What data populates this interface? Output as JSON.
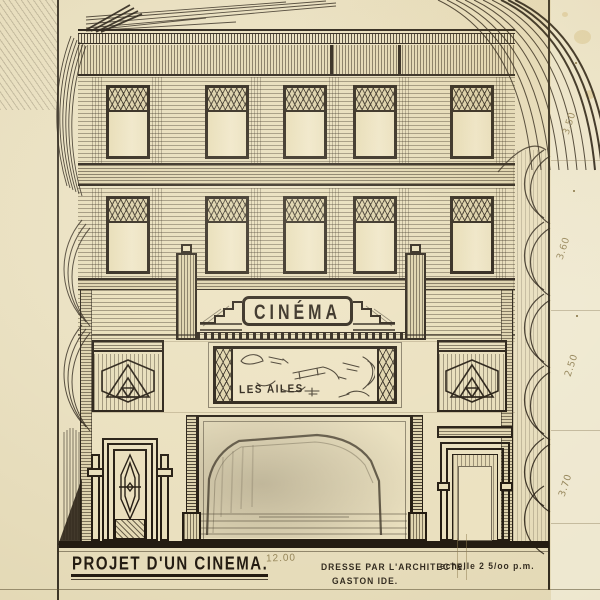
{
  "titles": {
    "project_title": "PROJET D'UN CINEMA.",
    "architect_line": "DRESSE PAR L'ARCHITECTE.",
    "architect_name": "GASTON IDE.",
    "scale_note": "echelle 2 5/oo p.m."
  },
  "facade": {
    "marquee_sign": "CINÉMA",
    "poster_title": "LES AILES"
  },
  "pencil": {
    "bottom_dimension": "12.00",
    "right_margin_dimensions": [
      "3.50",
      "3.60",
      "2.50",
      "3.70"
    ]
  },
  "colors": {
    "paper": "#e8debe",
    "paper_margin": "#f2ecd8",
    "ink": "#241c12",
    "pencil_graphite": "#8d7c4f"
  }
}
